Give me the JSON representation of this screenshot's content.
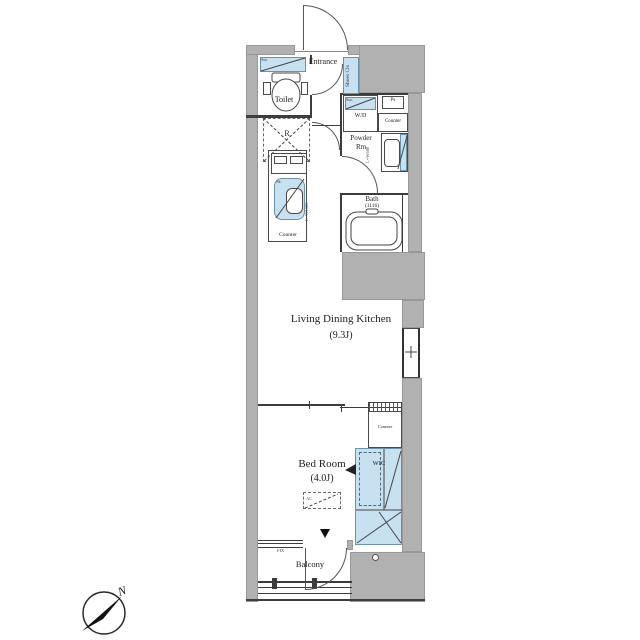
{
  "colors": {
    "wall_gray": "#b1b1b1",
    "fixture_blue": "#c8e1f1",
    "line": "#3c3c3c",
    "background": "#ffffff"
  },
  "compass": {
    "north_label": "N"
  },
  "labels": {
    "toilet": "Toilet",
    "toilet_storage": "Sto.",
    "entrance": "Entrance",
    "shoes_closet": "Shoes Cls",
    "washer_dryer": "W/D",
    "washer_storage": "Sto.",
    "pipe_space": "Ps",
    "powder_counter": "Counter",
    "powder_line1": "Powder",
    "powder_line2": "Rm",
    "basin_note": "L=W600",
    "bath": "Bath",
    "bath_size": "(1116)",
    "fridge": "R",
    "sink": "Sk.",
    "kitchen_note": "L=W1300",
    "kitchen_counter": "Counter",
    "ldk": "Living Dining Kitchen",
    "ldk_size": "(9.3J)",
    "bedroom": "Bed Room",
    "bedroom_size": "(4.0J)",
    "ac_unit": "AC",
    "bedroom_counter": "Counter",
    "wic": "WIC",
    "fix_window": "FIX",
    "balcony": "Balcony"
  }
}
